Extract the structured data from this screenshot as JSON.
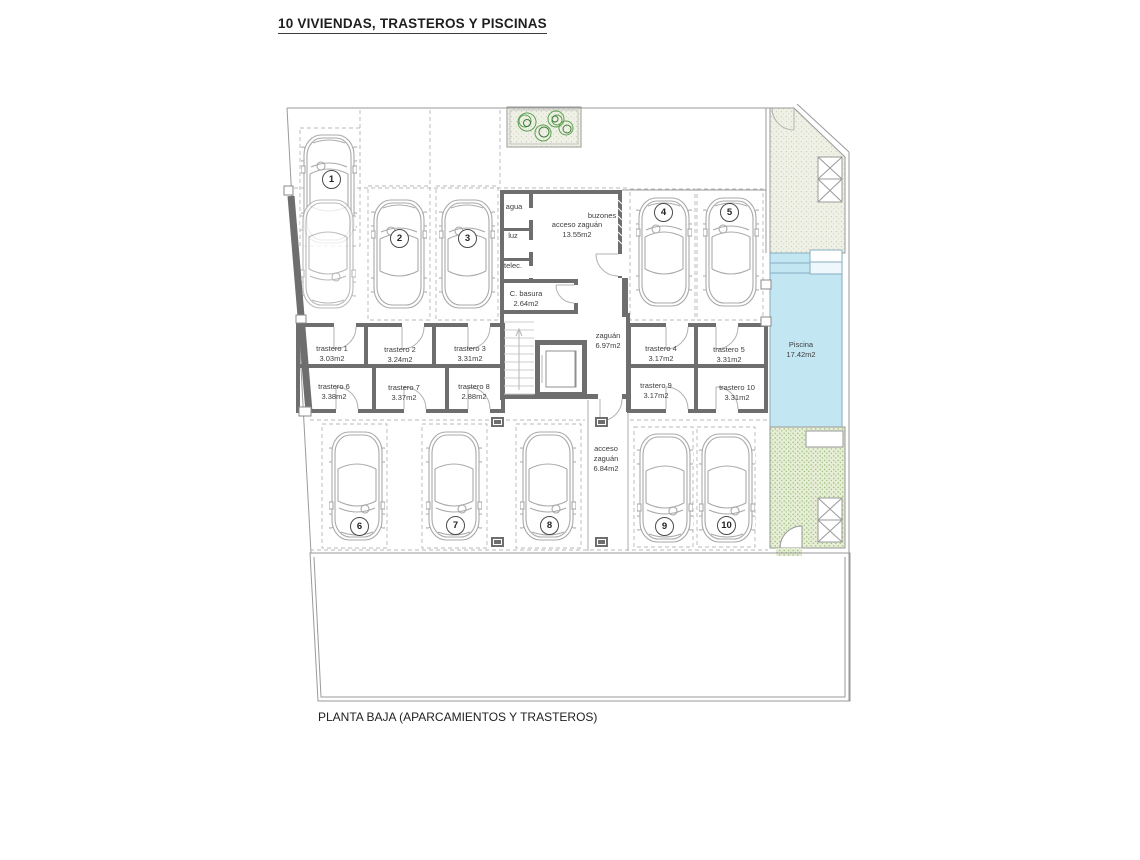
{
  "title": "10 VIVIENDAS, TRASTEROS Y PISCINAS",
  "footer": "PLANTA BAJA (APARCAMIENTOS Y TRASTEROS)",
  "colors": {
    "pool": "#c3e6f3",
    "wall": "#6e6e6e",
    "patio": "#eff1e6",
    "garden": "#e6eed6",
    "thin_line": "#9a9a9a"
  },
  "parking": {
    "numbers": [
      "1",
      "2",
      "3",
      "4",
      "5",
      "6",
      "7",
      "8",
      "9",
      "10"
    ]
  },
  "trasteros": [
    {
      "name": "trastero 1",
      "area": "3.03m2"
    },
    {
      "name": "trastero 2",
      "area": "3.24m2"
    },
    {
      "name": "trastero 3",
      "area": "3.31m2"
    },
    {
      "name": "trastero 4",
      "area": "3.17m2"
    },
    {
      "name": "trastero 5",
      "area": "3.31m2"
    },
    {
      "name": "trastero 6",
      "area": "3.38m2"
    },
    {
      "name": "trastero 7",
      "area": "3.37m2"
    },
    {
      "name": "trastero 8",
      "area": "2.88m2"
    },
    {
      "name": "trastero 9",
      "area": "3.17m2"
    },
    {
      "name": "trastero 10",
      "area": "3.31m2"
    }
  ],
  "rooms": {
    "agua": "agua",
    "luz": "luz",
    "telec": "telec.",
    "buzones": "buzones",
    "acceso_zaguan_top": {
      "name": "acceso zaguán",
      "area": "13.55m2"
    },
    "c_basura": {
      "name": "C. basura",
      "area": "2.64m2"
    },
    "zaguan": {
      "name": "zaguán",
      "area": "6.97m2"
    },
    "acceso_zaguan_bottom": {
      "line1": "acceso",
      "line2": "zaguán",
      "line3": "6.84m2"
    },
    "piscina": {
      "name": "Piscina",
      "area": "17.42m2"
    }
  }
}
